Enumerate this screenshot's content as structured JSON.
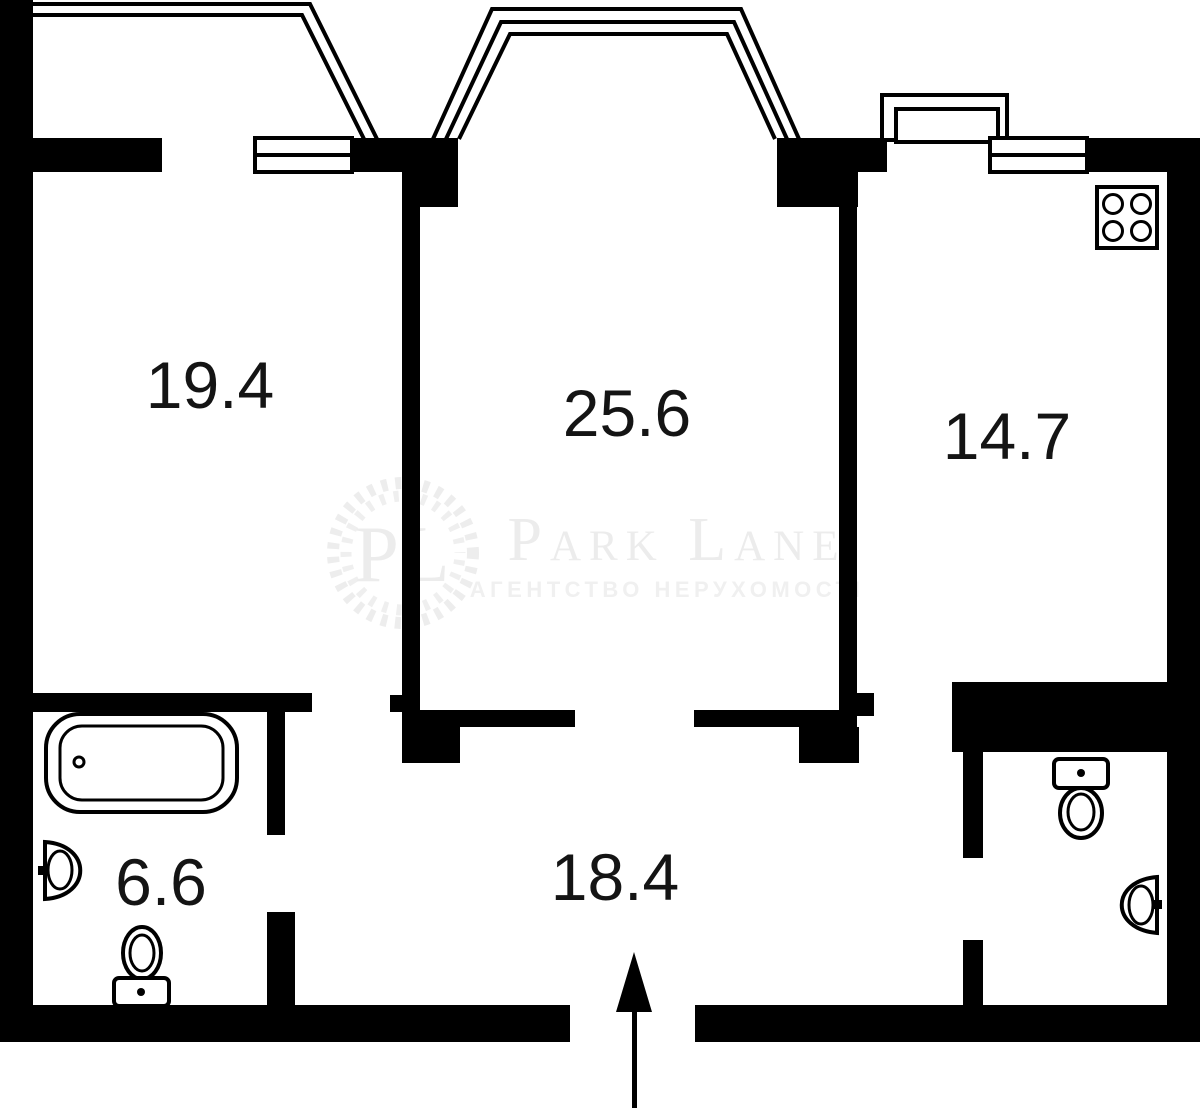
{
  "title": "Apartment floor plan",
  "watermark": {
    "monogram": "PL",
    "brand": "Park Lane",
    "tagline": "АГЕНТСТВО НЕРУХОМОСТІ"
  },
  "plan": {
    "rooms": [
      {
        "id": "living-room",
        "area": "19.4"
      },
      {
        "id": "main-room",
        "area": "25.6"
      },
      {
        "id": "kitchen",
        "area": "14.7"
      },
      {
        "id": "bathroom",
        "area": "6.6"
      },
      {
        "id": "hallway",
        "area": "18.4"
      }
    ],
    "fixtures": [
      "bathtub-icon",
      "bathroom-sink-icon",
      "bathroom-toilet-icon",
      "stove-icon",
      "wc-toilet-icon",
      "wc-sink-icon",
      "entry-arrow-icon",
      "bay-window-icon",
      "balcony-icon",
      "window-icon"
    ]
  },
  "colors": {
    "walls": "#000000",
    "background": "#ffffff",
    "watermark": "#ececec",
    "label_text": "#141414"
  }
}
